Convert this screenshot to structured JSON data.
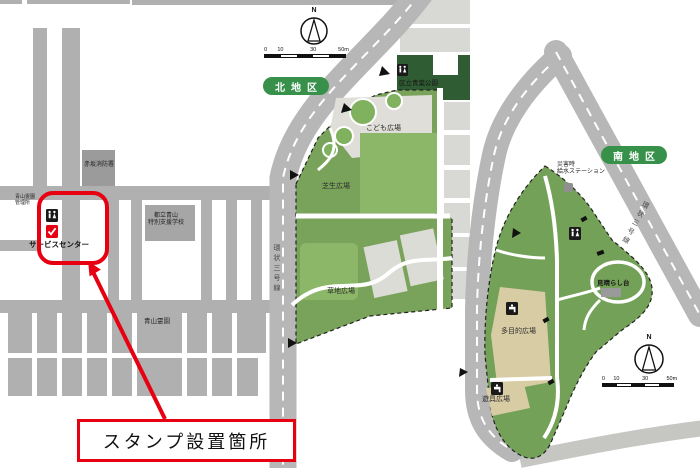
{
  "left_map": {
    "fire_station": "赤坂消防署",
    "cemetery_office": {
      "line1": "青山霊園",
      "line2": "管理所"
    },
    "school": {
      "line1": "都立青山",
      "line2": "特別支援学校"
    },
    "cemetery": "青山霊園",
    "service_center": "サービスセンター"
  },
  "north": {
    "badge": "北地区",
    "compass_n": "N",
    "scale": [
      "0",
      "10",
      "30",
      "50m"
    ],
    "adjacent_park": "区立青葉公園",
    "kodomo_hiroba": "こども広場",
    "shibafu_hiroba": "芝生広場",
    "kusachi_hiroba": "草地広場",
    "ring_road": "環状三号線"
  },
  "south": {
    "badge": "南地区",
    "compass_n": "N",
    "scale": [
      "0",
      "10",
      "30",
      "50m"
    ],
    "water_station": {
      "line1": "災害時",
      "line2": "給水ステーション"
    },
    "ring_road": "環状三号線",
    "miharashi": "見晴らし台",
    "tamokuteki_hiroba": "多目的広場",
    "yugu_hiroba": "遊具広場"
  },
  "annotation": {
    "stamp_location": "スタンプ設置箇所"
  },
  "colors": {
    "accent_red": "#e60012",
    "badge_green": "#38914b",
    "park_green": "#79a35a",
    "road_gray": "#b7b7b7"
  }
}
